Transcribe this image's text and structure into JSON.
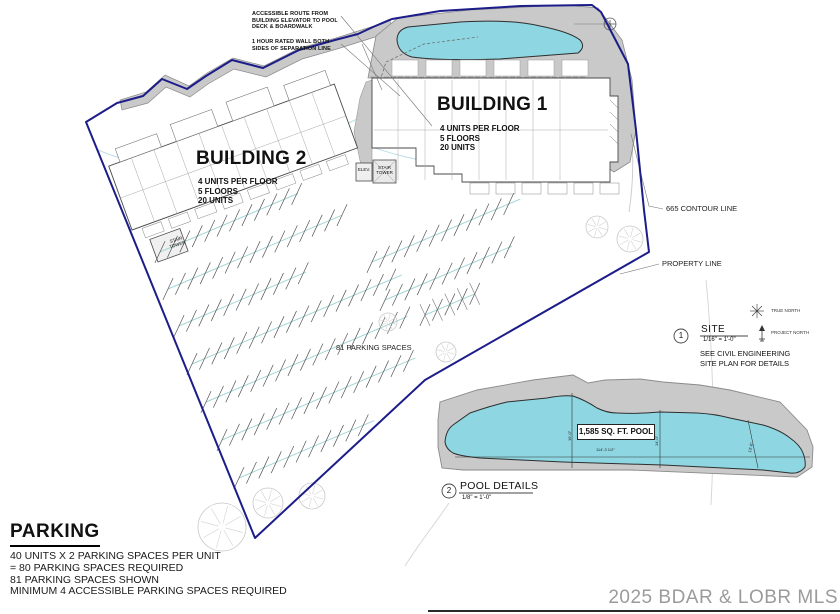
{
  "notes": {
    "accessible_route": "ACCESSIBLE ROUTE FROM\nBUILDING ELEVATOR TO POOL\nDECK & BOARDWALK",
    "rated_wall": "1 HOUR RATED WALL BOTH\nSIDES OF SEPARATION LINE"
  },
  "building1": {
    "title": "BUILDING 1",
    "specs": "4 UNITS PER FLOOR\n5 FLOORS\n20 UNITS"
  },
  "building2": {
    "title": "BUILDING 2",
    "specs": "4 UNITS PER FLOOR\n5 FLOORS\n20 UNITS"
  },
  "plan_labels": {
    "elev": "ELEV.",
    "stair_tower": "STAIR\nTOWER",
    "contour_line": "665 CONTOUR LINE",
    "property_line": "PROPERTY LINE",
    "parking_spaces": "81 PARKING SPACES",
    "true_north": "TRUE NORTH",
    "project_north": "PROJECT NORTH"
  },
  "callouts": {
    "site": {
      "number": "1",
      "title": "SITE",
      "scale": "1/16\" = 1'-0\"",
      "note": "SEE CIVIL ENGINEERING\nSITE PLAN FOR DETAILS"
    },
    "pool": {
      "number": "2",
      "title": "POOL DETAILS",
      "scale": "1/8\" = 1'-0\""
    }
  },
  "pool_detail": {
    "area_label": "1,585 SQ. FT. POOL",
    "dim_left": "16'-0\"",
    "dim_mid": "14'-0\"",
    "dim_right": "13'-6\"",
    "dim_bottom": "114'-3 1/2\""
  },
  "parking_summary": {
    "title": "PARKING",
    "lines": "40 UNITS X 2 PARKING SPACES PER UNIT\n= 80 PARKING SPACES REQUIRED\n81 PARKING SPACES SHOWN\nMINIMUM 4 ACCESSIBLE PARKING SPACES REQUIRED"
  },
  "watermark": "2025 BDAR & LOBR MLS",
  "colors": {
    "property_line": "#1d1d8a",
    "pool_water": "#8ed7e2",
    "deck": "#c9c9c9",
    "aisle": "#a5d5d5",
    "watermark": "#9b9b9b"
  }
}
